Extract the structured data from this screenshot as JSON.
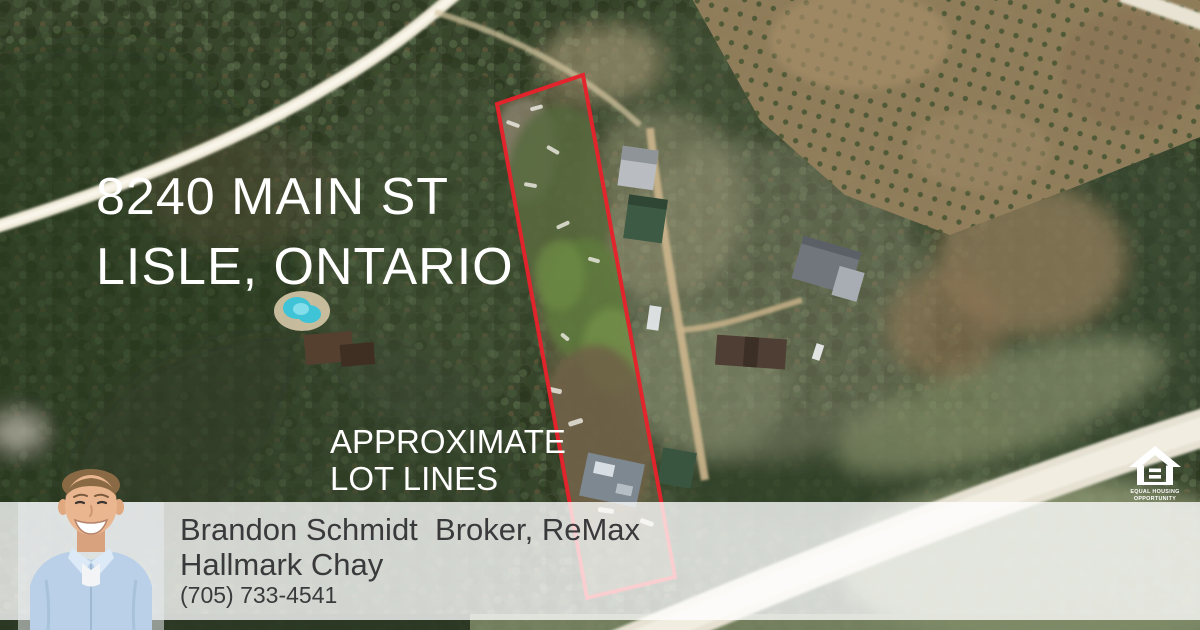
{
  "property": {
    "address_line1": "8240 MAIN ST",
    "address_line2": "LISLE, ONTARIO",
    "lot_note_line1": "APPROXIMATE",
    "lot_note_line2": "LOT LINES"
  },
  "agent": {
    "name_and_title": "Brandon Schmidt  Broker, ReMax",
    "brokerage": "Hallmark Chay",
    "phone": "(705) 733-4541"
  },
  "logo": {
    "equal_housing_line1": "EQUAL HOUSING",
    "equal_housing_line2": "OPPORTUNITY"
  },
  "colors": {
    "lot_line_red": "#e6222b",
    "overlay_text": "#ffffff",
    "banner_background": "rgba(255,255,255,0.78)",
    "banner_text": "#3a3a3c"
  }
}
